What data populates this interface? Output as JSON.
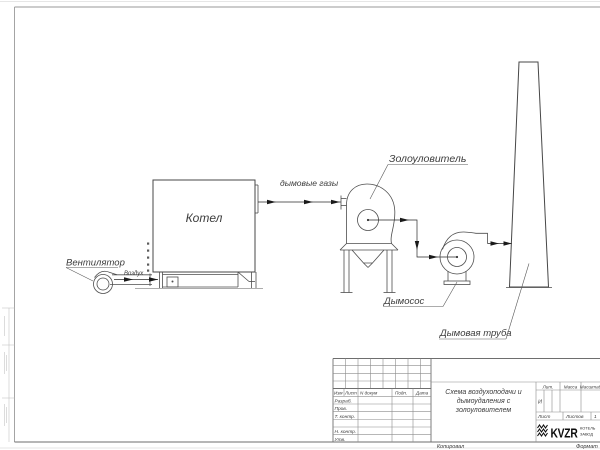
{
  "labels": {
    "fan": "Вентилятор",
    "air": "Воздух",
    "boiler": "Котел",
    "flue_gases": "дымовые газы",
    "ash_collector": "Золоуловитель",
    "smoke_exhauster": "Дымосос",
    "chimney": "Дымовая труба"
  },
  "title_block": {
    "header": {
      "izm": "Изм",
      "list": "Лист",
      "n_dokum": "N докум",
      "podp": "Подп.",
      "data": "Дата"
    },
    "rows": {
      "razrab": "Разраб.",
      "prov": "Пров.",
      "t_kontr": "Т. контр.",
      "n_kontr": "Н. контр.",
      "utv": "Утв."
    },
    "title_line1": "Схема воздухоподачи и",
    "title_line2": "дымоудаления с",
    "title_line3": "золоуловителем",
    "lit_header": "Лит.",
    "lit_value": "И",
    "massa_header": "Масса",
    "masshtab_header": "Масштаб",
    "list_label": "Лист",
    "listov_label": "Листов",
    "listov_value": "1",
    "logo_brand": "KVZR",
    "logo_sub1": "КОТЕЛЬ",
    "logo_sub2": "ЗАВОД",
    "kopiroval": "Копировал",
    "format": "Формат"
  },
  "colors": {
    "drawing_line": "#4d4d4d",
    "arrow": "#1a1a1a",
    "stamp_line": "#8c8c8c",
    "frame_line": "#9a9a9a",
    "text": "#3c3c3c"
  }
}
